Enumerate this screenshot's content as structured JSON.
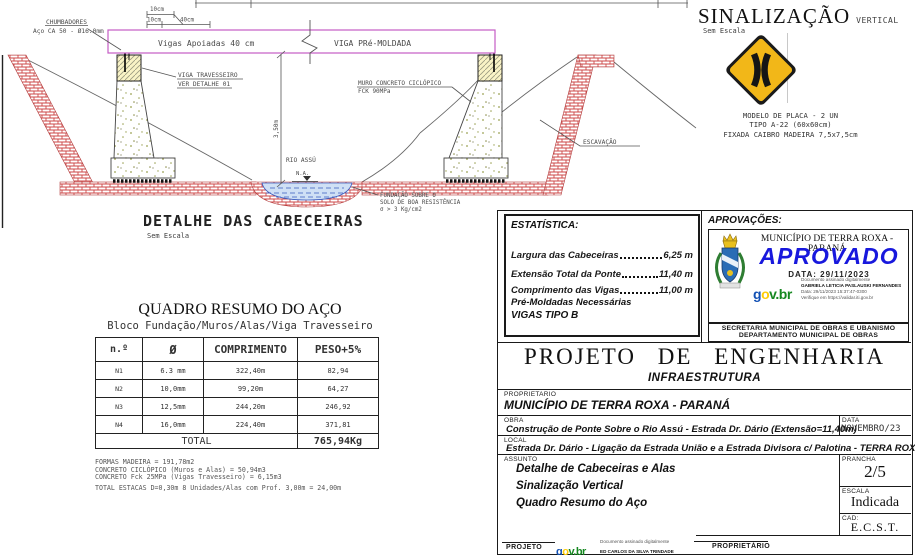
{
  "drawing": {
    "title": "DETALHE DAS CABECEIRAS",
    "scale_note": "Sem Escala",
    "labels": {
      "chumbadores_line1": "CHUMBADORES",
      "chumbadores_line2": "Aço CA 50 - Ø16.0mm",
      "dim_top_10cm": "10cm",
      "dim_10cm": "10cm",
      "dim_40cm": "40cm",
      "vigas_apoiadas": "Vigas Apoiadas 40 cm",
      "viga_pre_moldada": "VIGA PRé-MOLDADA",
      "viga_travesseiro_line1": "VIGA TRAVESSEIRO",
      "viga_travesseiro_line2": "VER DETALHE 01",
      "muro_line1": "MURO CONCRETO CICLÓPICO",
      "muro_line2": "FCK 90MPa",
      "dim_altura": "3,50m",
      "rio": "RIO ASSÚ",
      "nivel_agua": "N.A.",
      "fundacao_line1": "FUNDAÇÃO SOBRE O",
      "fundacao_line2": "SOLO DE BOA RESISTÊNCIA",
      "fundacao_line3": "σ > 3 Kg/cm2",
      "escavacao": "ESCAVAÇÃO"
    }
  },
  "sinalizacao": {
    "title": "SINALIZAÇÃO",
    "title_suffix": "VERTICAL",
    "scale_note": "Sem Escala",
    "note_line1": "MODELO DE PLACA - 2 UN",
    "note_line2": "TIPO A-22 (60x60cm)",
    "note_line3": "FIXADA CAIBRO MADEIRA 7,5x7,5cm"
  },
  "steel_table": {
    "title": "QUADRO RESUMO DO AÇO",
    "subtitle": "Bloco Fundação/Muros/Alas/Viga Travesseiro",
    "col_num": "n.º",
    "col_diam": "Ø",
    "col_comp": "COMPRIMENTO",
    "col_peso": "PESO+5%",
    "rows": [
      {
        "n": "N1",
        "d": "6.3 mm",
        "c": "322,40m",
        "p": "82,94"
      },
      {
        "n": "N2",
        "d": "10,0mm",
        "c": "99,20m",
        "p": "64,27"
      },
      {
        "n": "N3",
        "d": "12,5mm",
        "c": "244,20m",
        "p": "246,92"
      },
      {
        "n": "N4",
        "d": "16,0mm",
        "c": "224,40m",
        "p": "371,81"
      }
    ],
    "total_label": "TOTAL",
    "total_value": "765,94Kg"
  },
  "material_notes": {
    "line1": "FORMAS MADEIRA = 191,78m2",
    "line2": "CONCRETO CICLÓPICO (Muros e Alas)  = 50,94m3",
    "line3": "CONCRETO Fck 25MPa (Vigas Travesseiro)  = 6,15m3",
    "line4": "TOTAL ESTACAS D=0,30m 8 Unidades/Alas com Prof. 3,00m = 24,00m"
  },
  "estatistica": {
    "title": "ESTATÍSTICA:",
    "item1_label": "Largura das Cabeceiras",
    "item1_value": "6,25 m",
    "item2_label": "Extensão Total da Ponte",
    "item2_value": "11,40 m",
    "item3_label": "Comprimento das Vigas",
    "item3_value": "11,00 m",
    "item3_extra": "Pré-Moldadas Necessárias",
    "item3_extra2": "VIGAS TIPO B"
  },
  "aprovacoes": {
    "title": "APROVAÇÕES:",
    "municipio": "MUNICÍPIO DE TERRA ROXA - PARANÁ",
    "stamp": "APROVADO",
    "stamp_date": "DATA: 29/11/2023",
    "govbr_g": "g",
    "govbr_o": "o",
    "govbr_v": "v",
    "govbr_br": "v.br",
    "sig_line1": "Documento assinado digitalmente",
    "sig_line2": "GABRIELA LETICIA PASLAUSKI FERNANDES",
    "sig_line3": "Data: 29/11/2023 15:37:47-0300",
    "sig_line4": "Verifique em https://validar.iti.gov.br",
    "secretaria_line1": "SECRETARIA MUNICIPAL DE OBRAS E UBANISMO",
    "secretaria_line2": "DEPARTAMENTO MUNICIPAL DE OBRAS"
  },
  "titleblock": {
    "main_title": "PROJETO DE ENGENHARIA",
    "main_subtitle": "INFRAESTRUTURA",
    "proprietario_label": "PROPRIETARIO",
    "proprietario_value": "MUNICÍPIO DE TERRA ROXA - PARANÁ",
    "obra_label": "OBRA",
    "obra_value": "Construção de Ponte Sobre o Rio Assú - Estrada Dr. Dário (Extensão=11,40m)",
    "data_label": "DATA",
    "data_value": "NOVEMBRO/23",
    "local_label": "LOCAL",
    "local_value": "Estrada Dr. Dário - Ligação da Estrada União e a Estrada Divisora c/ Palotina - TERRA ROXA/PR",
    "assunto_label": "ASSUNTO",
    "assunto_line1": "Detalhe de Cabeceiras e Alas",
    "assunto_line2": "Sinalização Vertical",
    "assunto_line3": "Quadro Resumo do Aço",
    "prancha_label": "PRANCHA",
    "prancha_value": "2/5",
    "escala_label": "ESCALA",
    "escala_value": "Indicada",
    "cad_label": "CAD:",
    "cad_value": "E.C.S.T.",
    "projeto_label": "PROJETO",
    "proj_sig_line1": "Documento assinado digitalmente",
    "proj_sig_line2": "ED CARLOS DA SILVA TRINDADE",
    "proprietario2_label": "PROPRIETÁRIO"
  },
  "colors": {
    "beam_magenta": "#c55cc5",
    "hatch_red": "#cc4747",
    "water_blue": "#3a5bbf",
    "sign_yellow": "#f2b718",
    "aprovado_blue": "#1818dd",
    "govbr_blue": "#1351b4",
    "govbr_yellow": "#ffcd07",
    "govbr_green": "#168821"
  }
}
